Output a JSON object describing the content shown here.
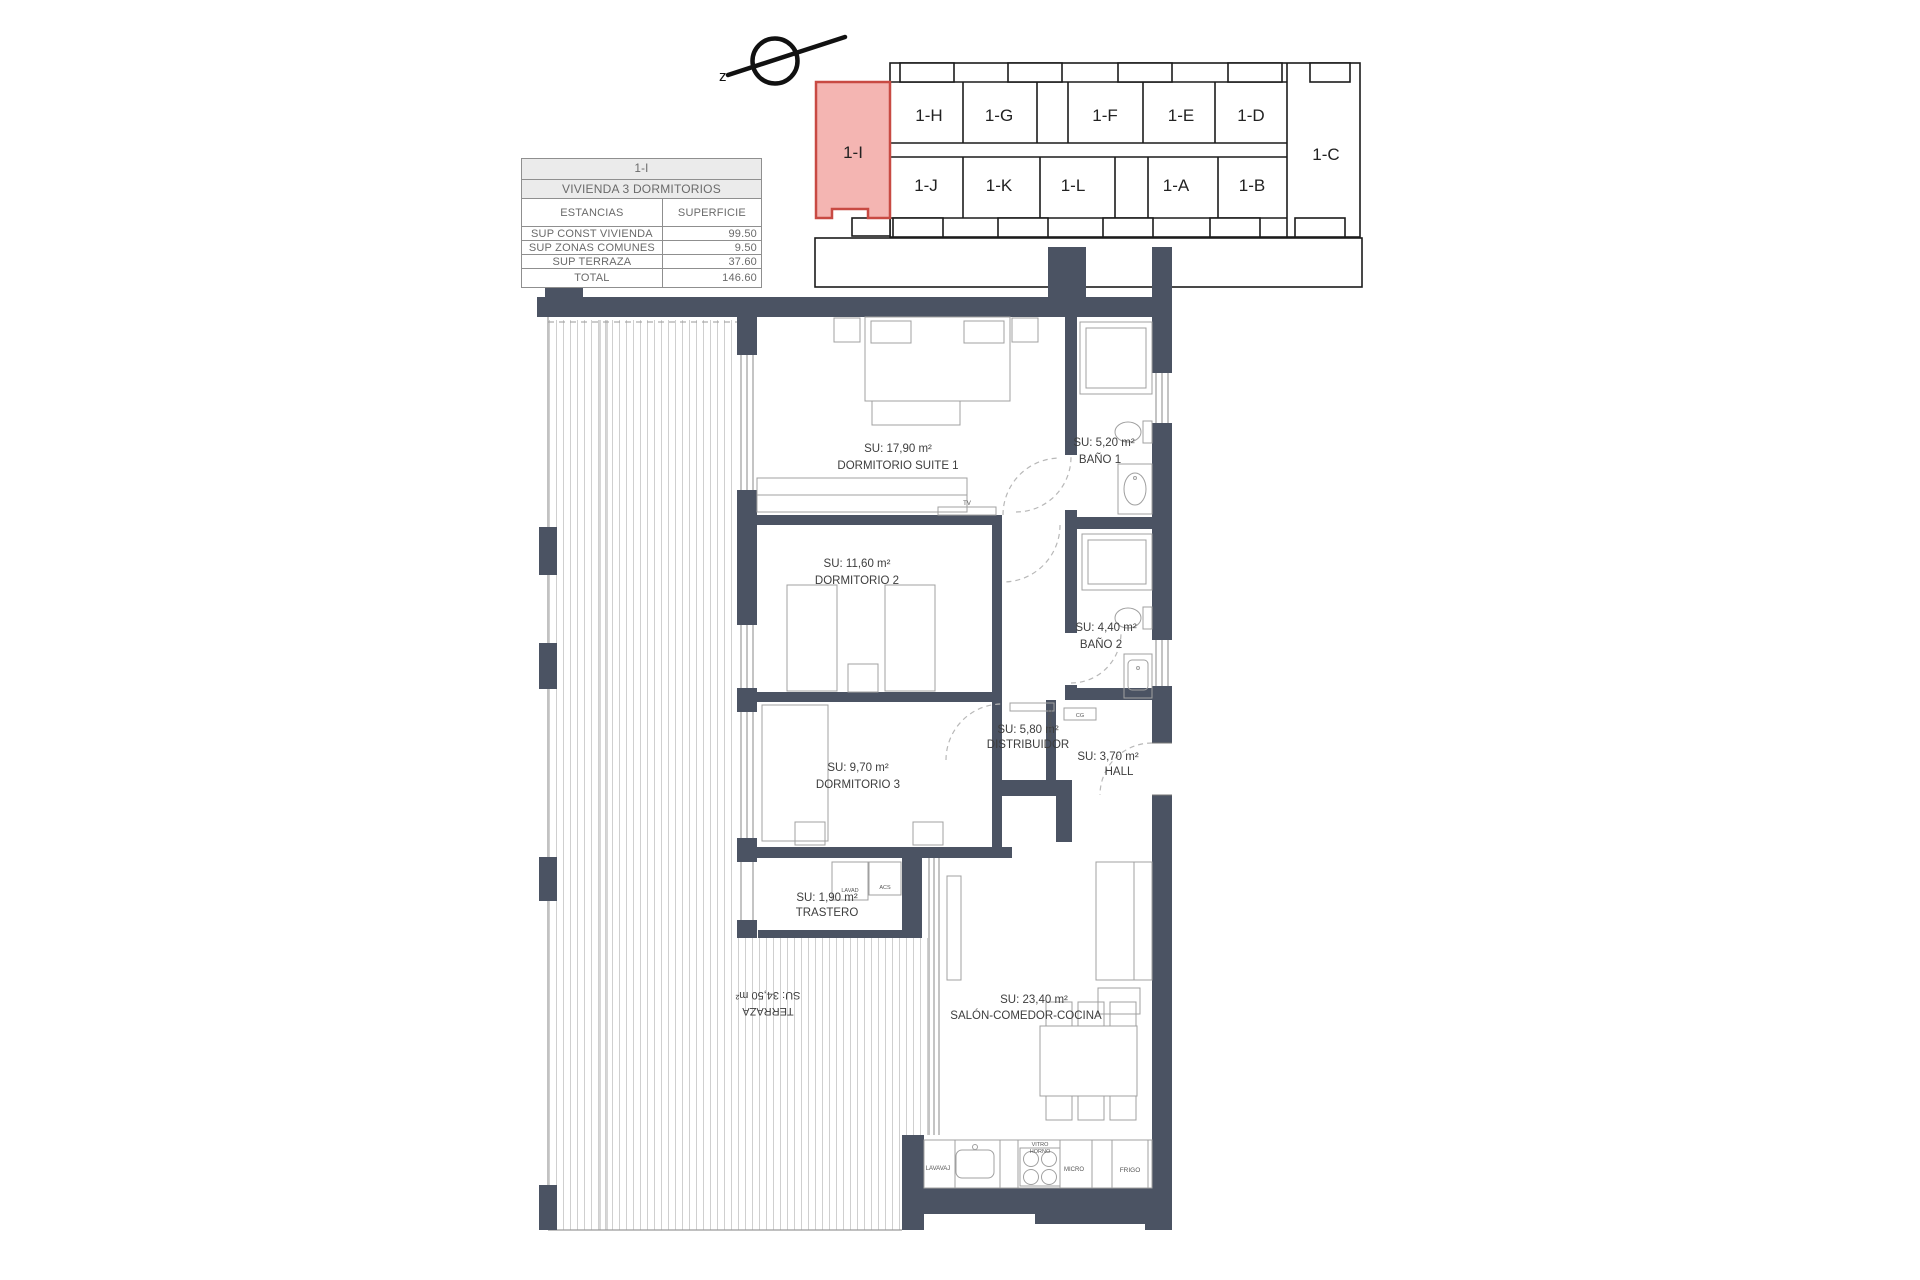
{
  "summary_table": {
    "unit": "1-I",
    "title": "VIVIENDA 3 DORMITORIOS",
    "columns": {
      "estancias": "ESTANCIAS",
      "superficie": "SUPERFICIE"
    },
    "rows": [
      {
        "label": "SUP CONST VIVIENDA",
        "value": "99.50"
      },
      {
        "label": "SUP ZONAS COMUNES",
        "value": "9.50"
      },
      {
        "label": "SUP TERRAZA",
        "value": "37.60"
      },
      {
        "label": "TOTAL",
        "value": "146.60"
      }
    ]
  },
  "key_plan": {
    "north_label": "z",
    "highlight_fill": "#f4b5b2",
    "highlight_stroke": "#c84a43",
    "labels": {
      "i": "1-I",
      "h": "1-H",
      "g": "1-G",
      "f": "1-F",
      "e": "1-E",
      "d": "1-D",
      "c": "1-C",
      "j": "1-J",
      "k": "1-K",
      "l": "1-L",
      "a": "1-A",
      "b": "1-B"
    }
  },
  "floor_plan": {
    "wall_color": "#4b5363",
    "rooms": {
      "suite1": {
        "area": "SU: 17,90 m²",
        "name": "DORMITORIO SUITE 1"
      },
      "bano1": {
        "area": "SU: 5,20 m²",
        "name": "BAÑO 1"
      },
      "dorm2": {
        "area": "SU: 11,60 m²",
        "name": "DORMITORIO 2"
      },
      "bano2": {
        "area": "SU: 4,40 m²",
        "name": "BAÑO 2"
      },
      "distribuidor": {
        "area": "SU: 5,80 m²",
        "name": "DISTRIBUIDOR"
      },
      "hall": {
        "area": "SU: 3,70 m²",
        "name": "HALL"
      },
      "dorm3": {
        "area": "SU: 9,70 m²",
        "name": "DORMITORIO 3"
      },
      "trastero": {
        "area": "SU: 1,90 m²",
        "name": "TRASTERO"
      },
      "salon": {
        "area": "SU: 23,40 m²",
        "name": "SALÓN-COMEDOR-COCINA"
      },
      "terraza": {
        "area": "SU: 34,50 m²",
        "name": "TERRAZA"
      }
    },
    "fixtures": {
      "tv": "TV",
      "lavadora": "LAVAD",
      "acs": "ACS",
      "interfono": "INTERFONO",
      "cuadro_general": "CG",
      "lavavajillas": "LAVAVAJ",
      "vitro": "VITRO",
      "horno": "HORNO",
      "micro": "MICRO",
      "frigo": "FRIGO"
    }
  }
}
